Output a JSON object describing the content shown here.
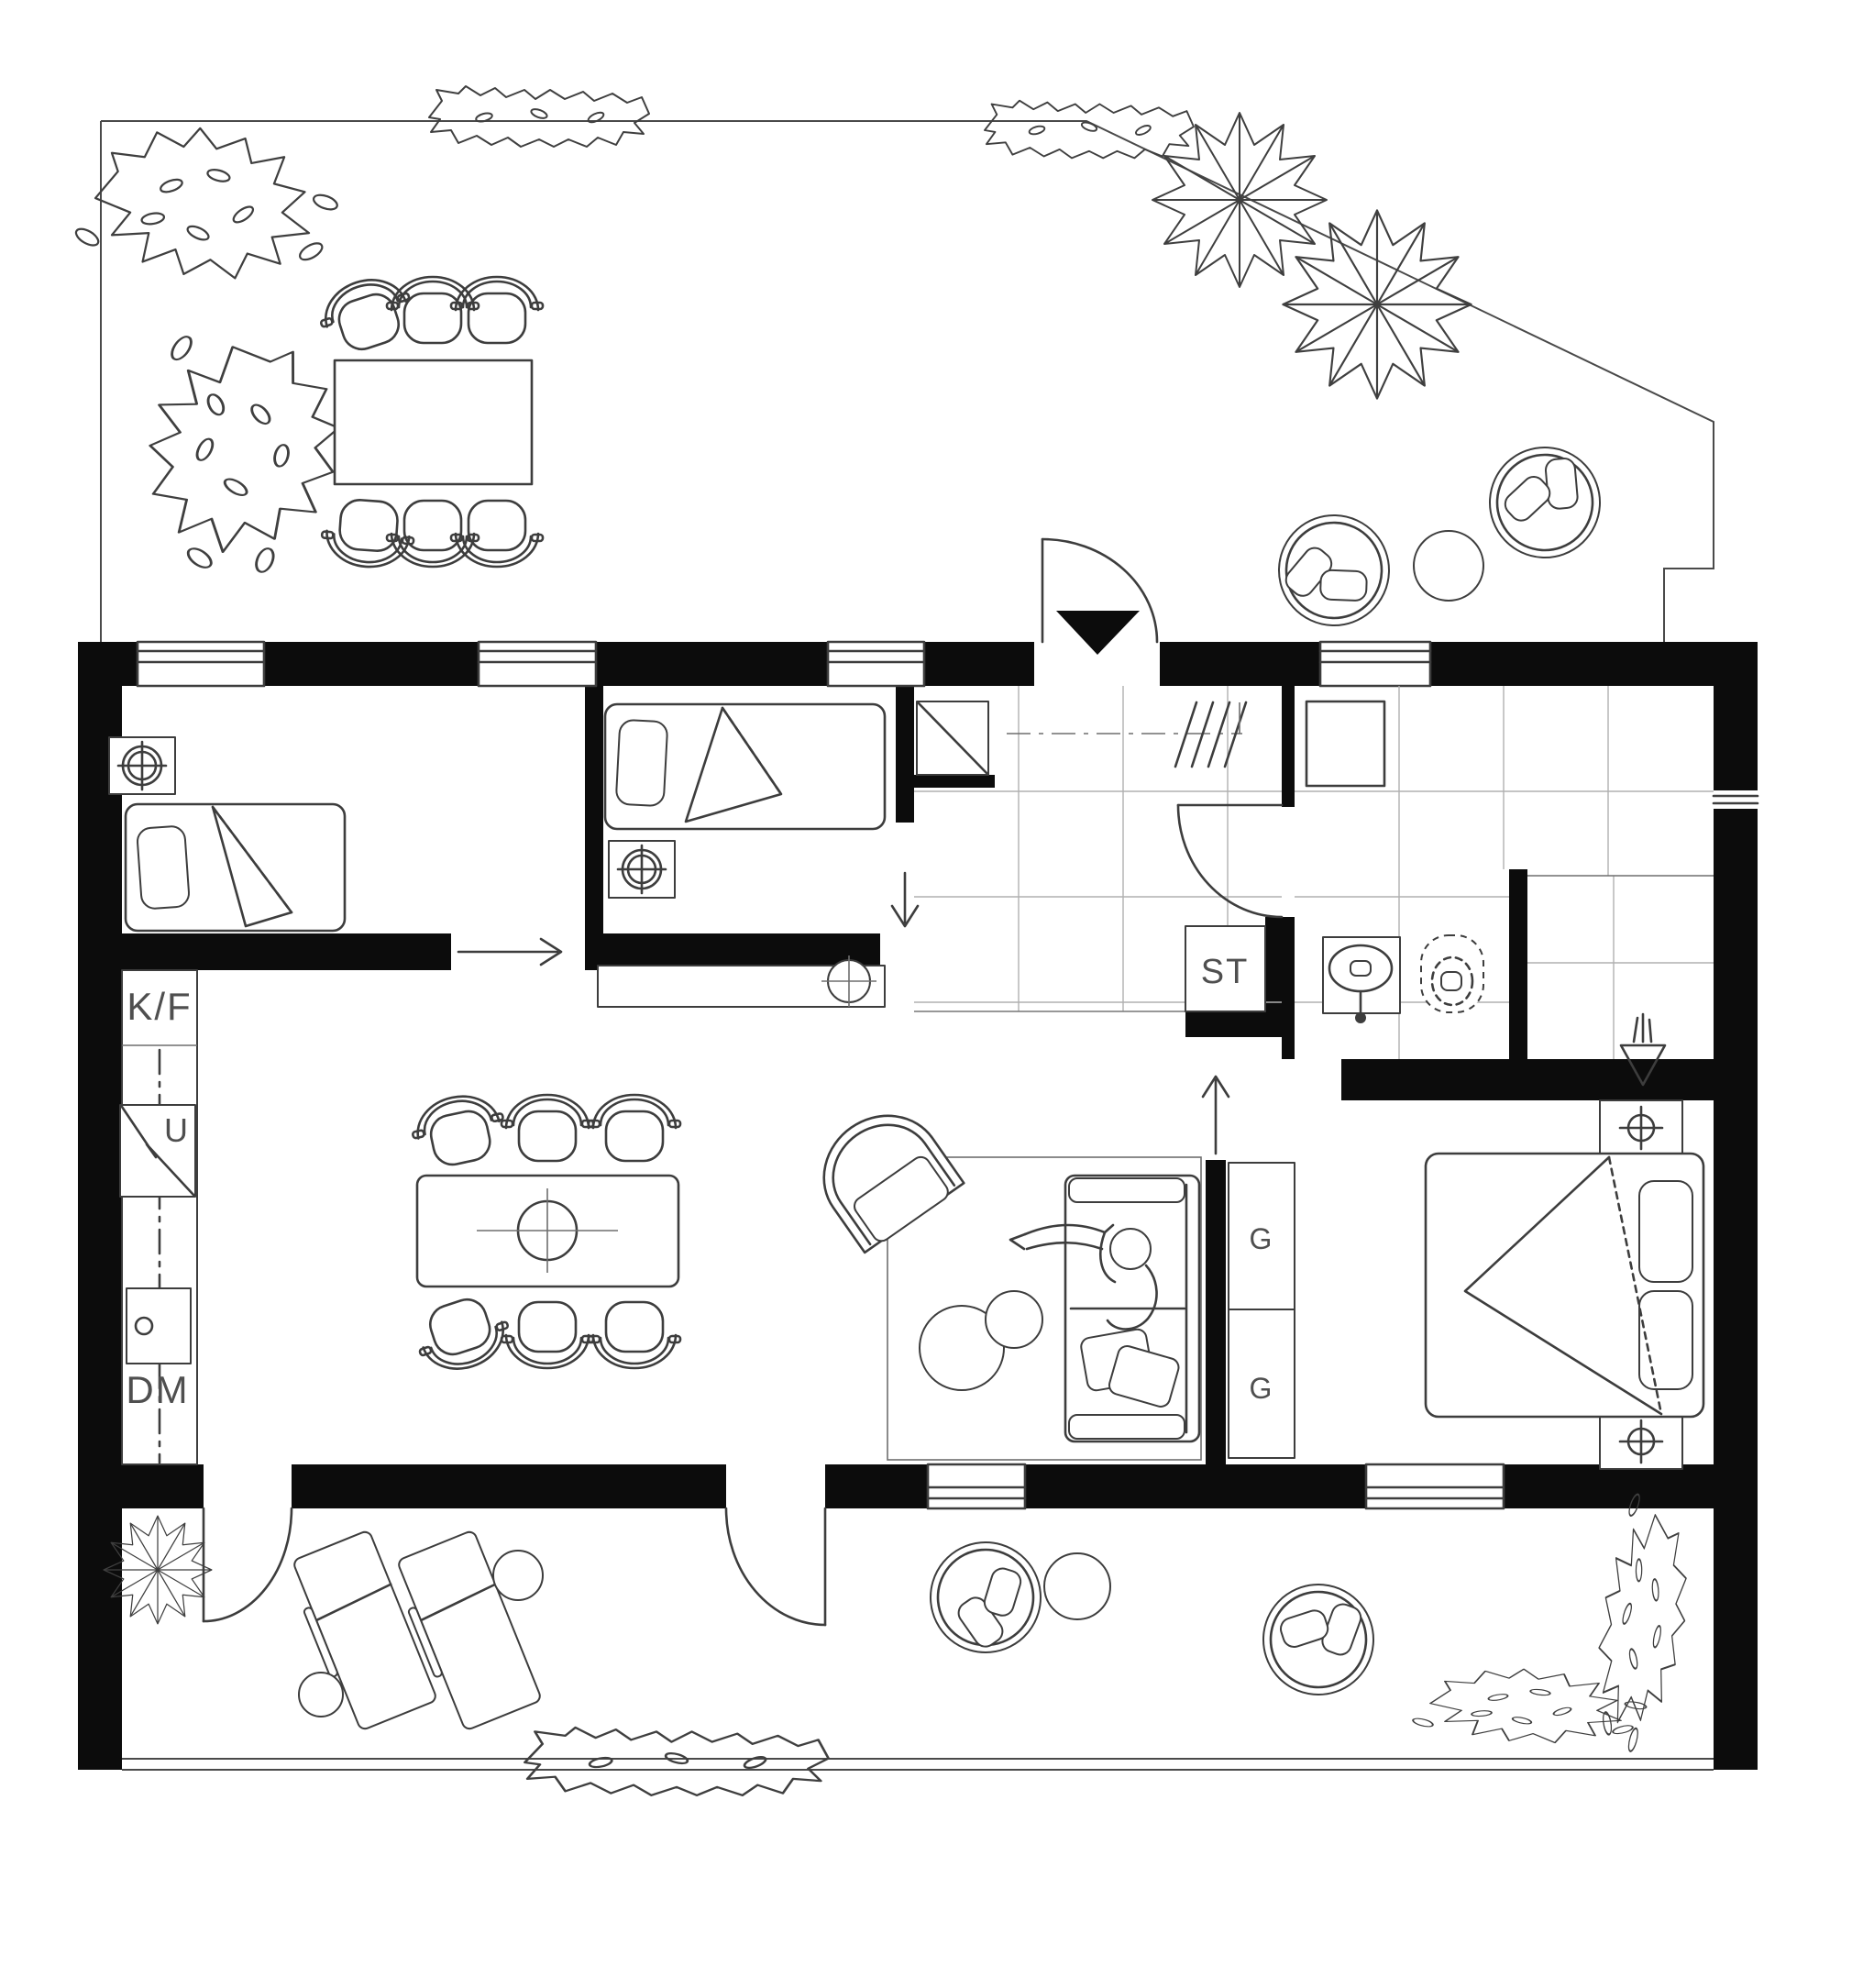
{
  "plan": {
    "labels": {
      "fridge_freezer": "K/F",
      "oven": "U",
      "dishwasher": "DM",
      "storage": "ST",
      "wardrobe_top": "G",
      "wardrobe_bottom": "G"
    },
    "colors": {
      "background": "#ffffff",
      "wall": "#0c0c0c",
      "line": "#3d3d3d",
      "tile_line": "#b0b0b0",
      "label_text": "#4f4f4f"
    },
    "icons": {
      "entrance": "entrance-triangle-icon",
      "lamp": "ceiling-lamp-icon",
      "sink": "sink-icon",
      "toilet": "toilet-icon",
      "floor_drain": "floor-drain-icon",
      "shower_plant": "drain-splash-icon"
    }
  }
}
